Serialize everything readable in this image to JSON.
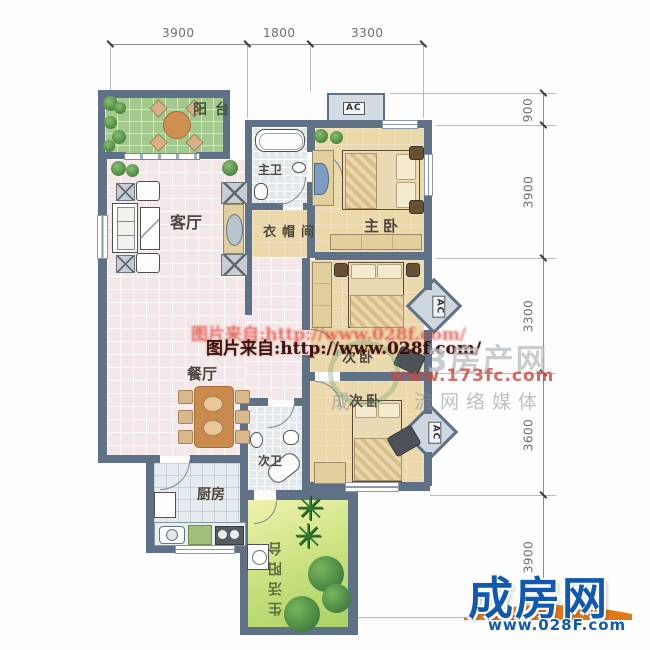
{
  "dims": {
    "top": [
      "3900",
      "1800",
      "3300"
    ],
    "right": [
      "900",
      "3900",
      "3300",
      "3600",
      "3900"
    ]
  },
  "rooms": {
    "balcony": "阳台",
    "living": "客厅",
    "dining": "餐厅",
    "master_bath": "主卫",
    "closet": "衣帽间",
    "master_bed": "主卧",
    "second_bed_a": "次卧",
    "second_bed_b": "次卧",
    "second_bath": "次卫",
    "kitchen": "厨房",
    "utility_balcony": "生活阳台"
  },
  "ac": {
    "unit": "AC"
  },
  "watermarks": {
    "photo_credit_blur": "图片来自:http://www.028f.com/",
    "photo_credit": "图片来自:http://www.028f.com/",
    "portal_name": "3房产网",
    "portal_url": "www.173fc.com",
    "tagline_left": "成",
    "tagline_right": "流网络媒体"
  },
  "logo": {
    "name": "成房网",
    "url": "www.028F.com",
    "brand_blue": "#1159b0",
    "brand_orange": "#e07818"
  }
}
